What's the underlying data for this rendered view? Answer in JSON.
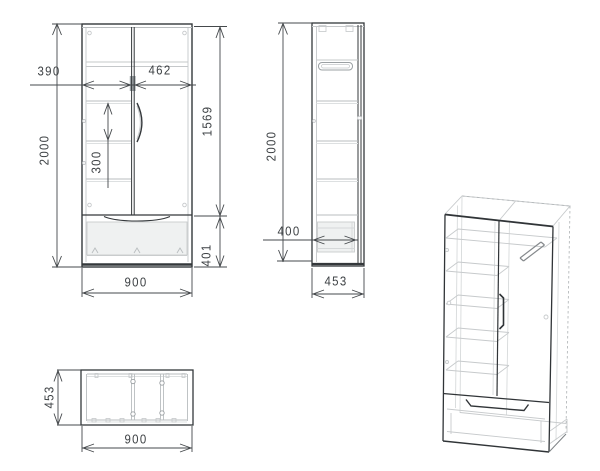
{
  "views": {
    "front": {
      "dims": {
        "height": "2000",
        "left_opening": "390",
        "right_opening": "462",
        "shelf_spacing": "300",
        "door_section_height": "1569",
        "width": "900",
        "drawer_section_height": "401"
      }
    },
    "side": {
      "dims": {
        "height": "2000",
        "drawer_depth": "400",
        "depth": "453"
      }
    },
    "plan": {
      "dims": {
        "depth": "453",
        "width": "900"
      }
    }
  },
  "colors": {
    "background": "#ffffff",
    "line_dark": "#34383b",
    "line_light": "#c5c8ca",
    "line_mid": "#9ba0a3",
    "dimension_line": "#45494c",
    "text": "#3d4144",
    "gap_highlight_bar": "#9aa0a4",
    "drawer_fill": "#eff1f1"
  }
}
